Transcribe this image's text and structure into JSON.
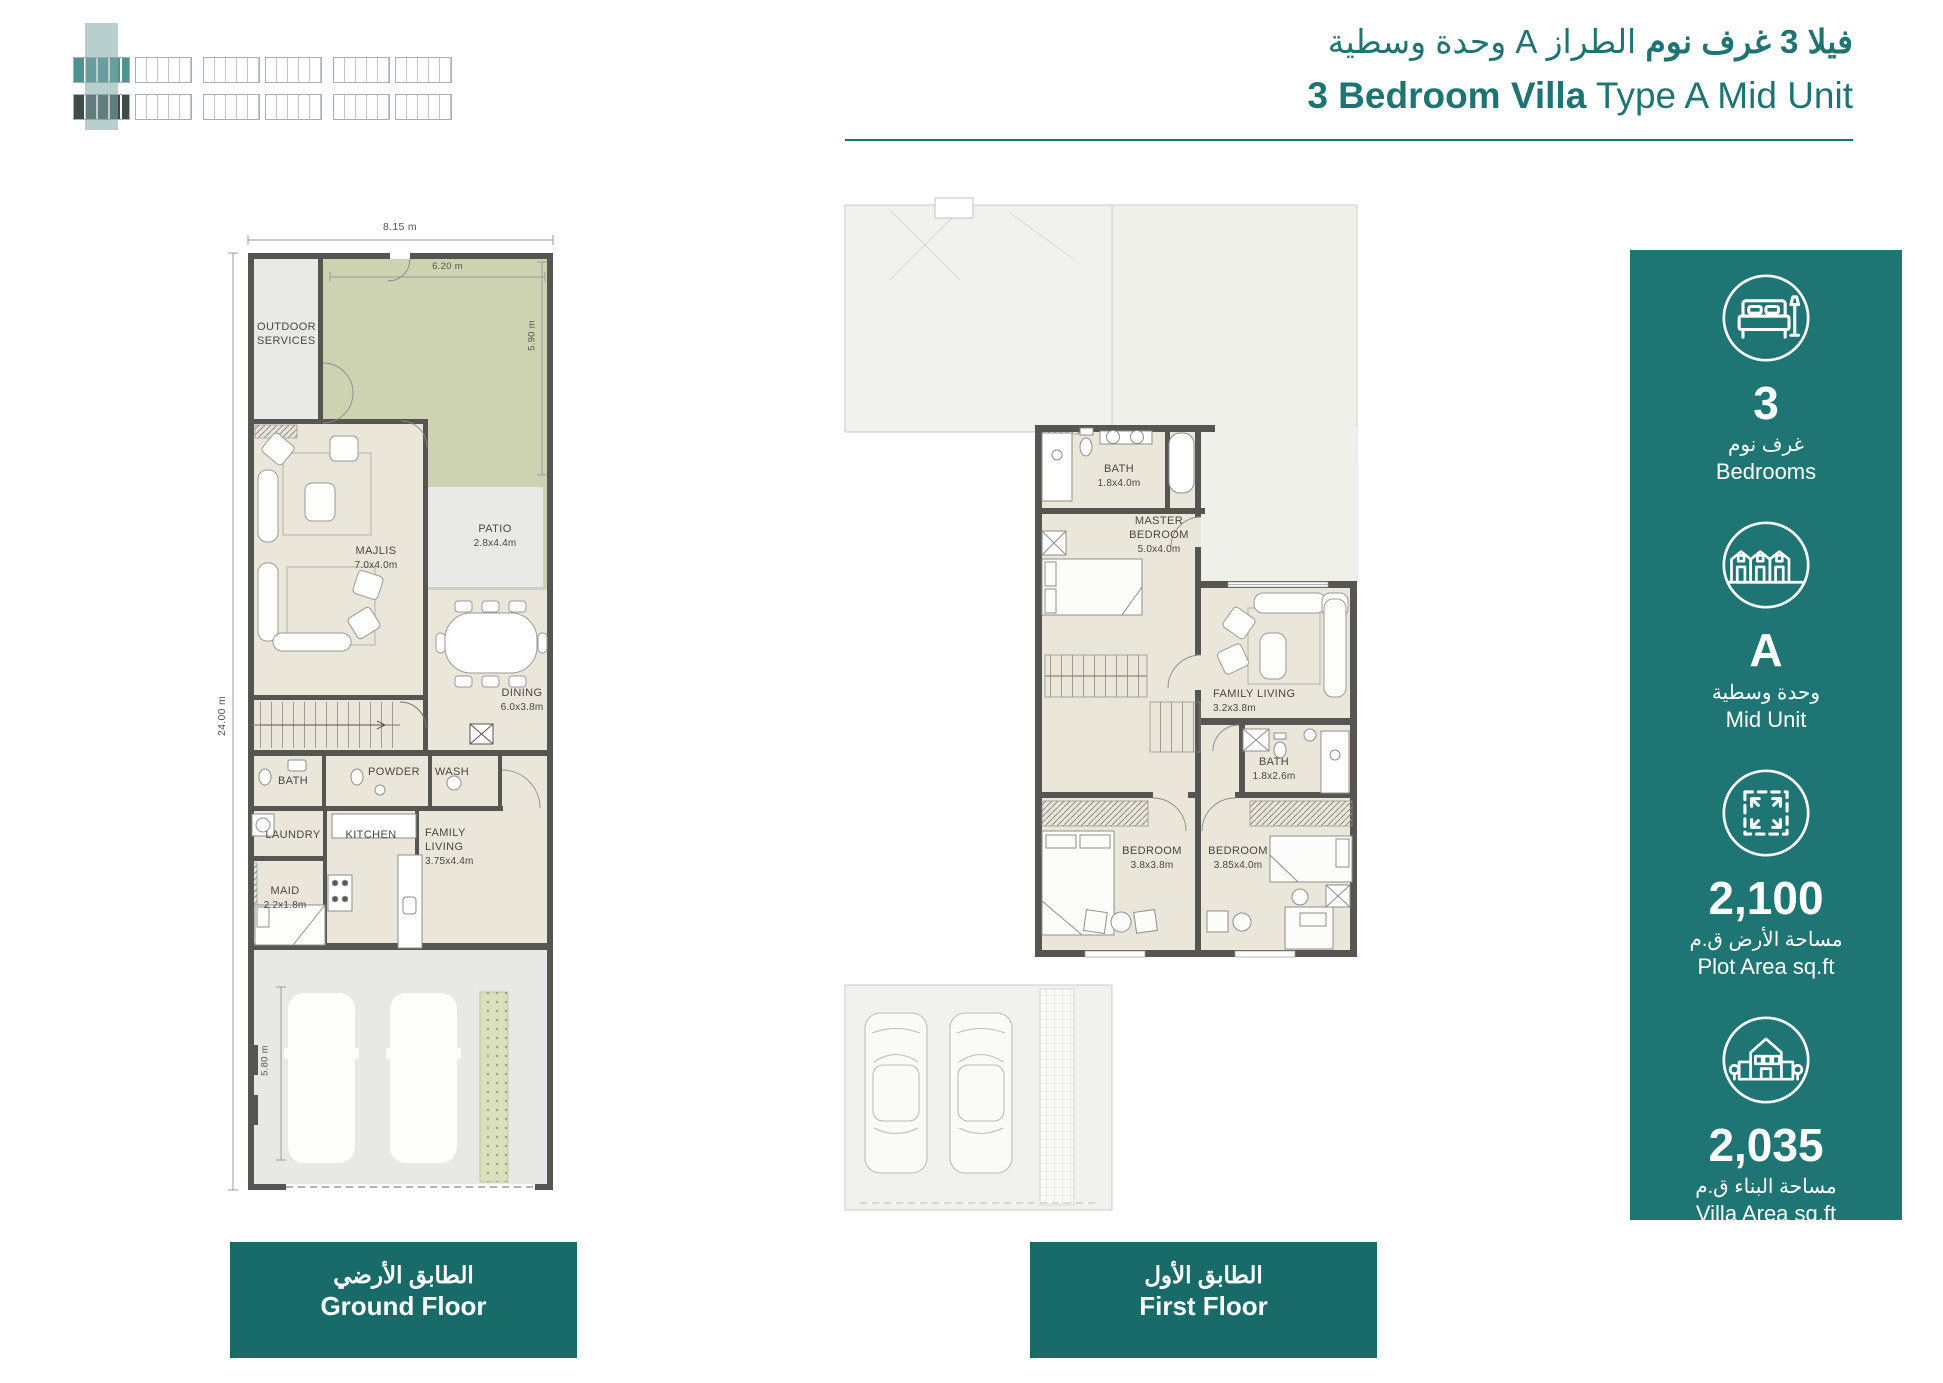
{
  "header": {
    "title_ar_bold": "فيلا 3 غرف نوم",
    "title_ar_rest": "الطراز A وحدة وسطية",
    "title_en_bold": "3 Bedroom Villa",
    "title_en_rest": "Type A Mid Unit"
  },
  "ground_floor": {
    "dims": {
      "width": "8.15 m",
      "height": "24.00 m",
      "garden_width": "6.20 m",
      "garden_depth": "5.90 m",
      "garage_depth": "5.80 m"
    },
    "rooms": {
      "outdoor_services": {
        "name": "OUTDOOR SERVICES"
      },
      "majlis": {
        "name": "MAJLIS",
        "size": "7.0x4.0m"
      },
      "patio": {
        "name": "PATIO",
        "size": "2.8x4.4m"
      },
      "dining": {
        "name": "DINING",
        "size": "6.0x3.8m"
      },
      "bath": {
        "name": "BATH"
      },
      "powder": {
        "name": "POWDER"
      },
      "wash": {
        "name": "WASH"
      },
      "laundry": {
        "name": "LAUNDRY"
      },
      "kitchen": {
        "name": "KITCHEN"
      },
      "family_living": {
        "name": "FAMILY LIVING",
        "size": "3.75x4.4m"
      },
      "maid": {
        "name": "MAID",
        "size": "2.2x1.8m"
      }
    },
    "badge_ar": "الطابق الأرضي",
    "badge_en": "Ground Floor"
  },
  "first_floor": {
    "rooms": {
      "bath1": {
        "name": "BATH",
        "size": "1.8x4.0m"
      },
      "master": {
        "name": "MASTER BEDROOM",
        "size": "5.0x4.0m"
      },
      "family_living": {
        "name": "FAMILY LIVING",
        "size": "3.2x3.8m"
      },
      "bath2": {
        "name": "BATH",
        "size": "1.8x2.6m"
      },
      "bedroom1": {
        "name": "BEDROOM",
        "size": "3.8x3.8m"
      },
      "bedroom2": {
        "name": "BEDROOM",
        "size": "3.85x4.0m"
      }
    },
    "badge_ar": "الطابق الأول",
    "badge_en": "First Floor"
  },
  "stats": [
    {
      "icon": "bed-icon",
      "value": "3",
      "label_ar": "غرف نوم",
      "label_en": "Bedrooms"
    },
    {
      "icon": "townhouse-icon",
      "value": "A",
      "label_ar": "وحدة وسطية",
      "label_en": "Mid Unit"
    },
    {
      "icon": "plot-area-icon",
      "value": "2,100",
      "label_ar": "مساحة الأرض ق.م",
      "label_en": "Plot Area sq.ft"
    },
    {
      "icon": "villa-area-icon",
      "value": "2,035",
      "label_ar": "مساحة البناء ق.م",
      "label_en": "Villa Area sq.ft"
    }
  ],
  "colors": {
    "teal": "#1d7472",
    "panel": "#1e7573",
    "badge": "#196b69",
    "garden": "#cdd3b1",
    "wall": "#565551",
    "floor_beige": "#ebe6da"
  }
}
